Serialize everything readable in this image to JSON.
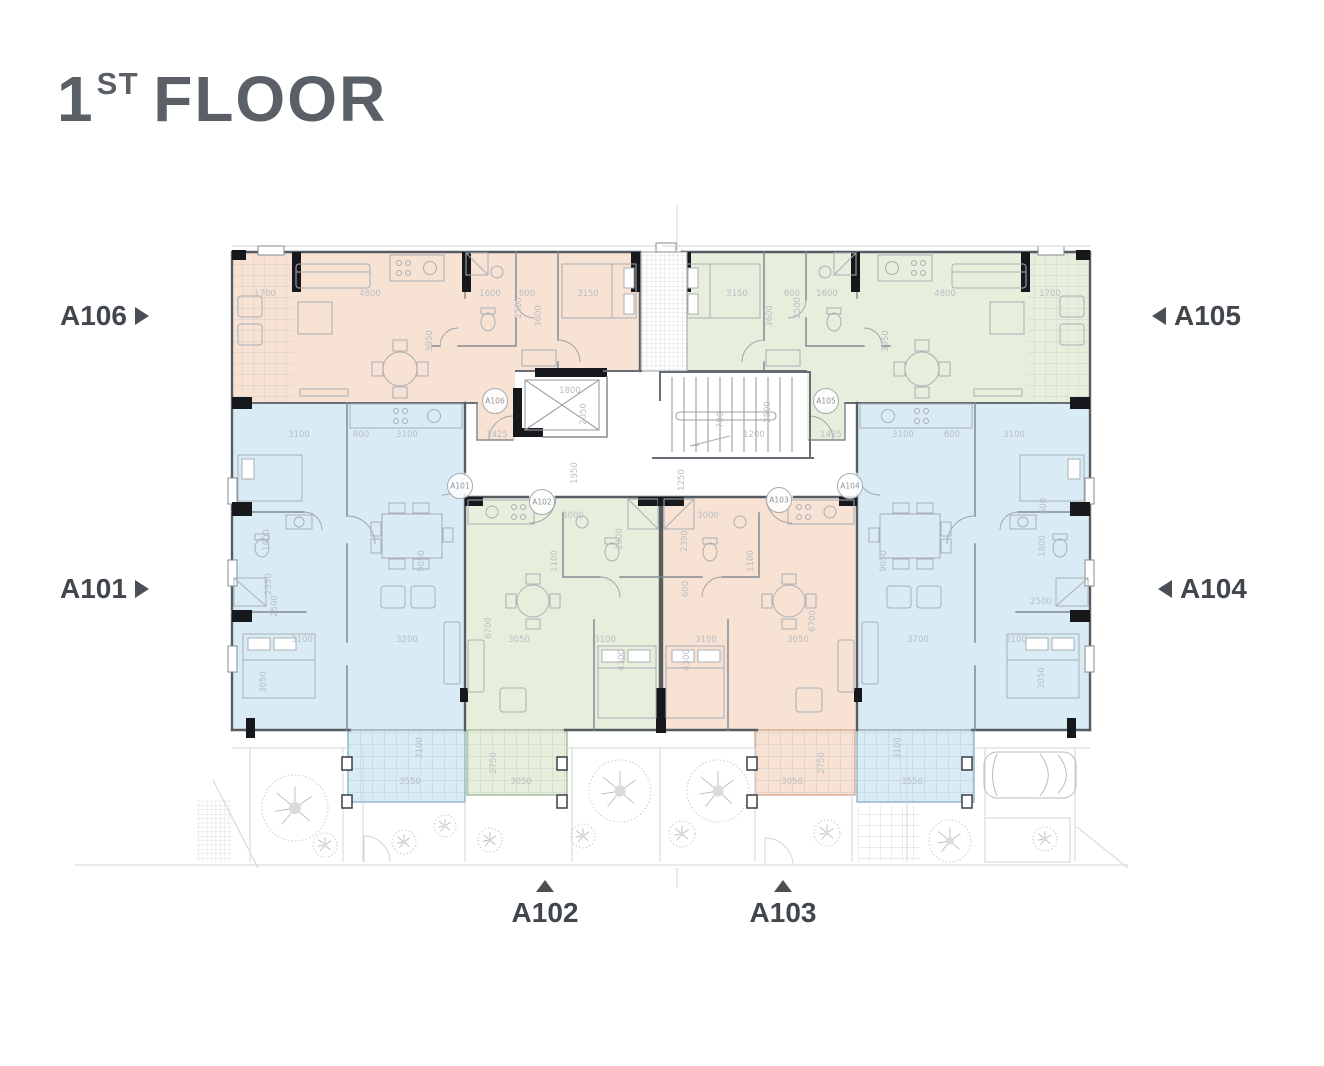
{
  "title": {
    "number": "1",
    "sup": "ST",
    "word": "FLOOR"
  },
  "callouts": {
    "a106": {
      "label": "A106",
      "arrow": "right"
    },
    "a105": {
      "label": "A105",
      "arrow": "left"
    },
    "a101": {
      "label": "A101",
      "arrow": "right"
    },
    "a104": {
      "label": "A104",
      "arrow": "left"
    },
    "a102": {
      "label": "A102",
      "arrow": "up"
    },
    "a103": {
      "label": "A103",
      "arrow": "up"
    }
  },
  "colors": {
    "title_text": "#5a6066",
    "callout_text": "#41474d",
    "wall": "#565c62",
    "black_wall": "#17181c",
    "dim_text": "#b9bec4",
    "peach": "#f8e2d3",
    "green": "#e7efdc",
    "blue": "#d9ecf6"
  },
  "units": [
    {
      "id": "A106",
      "fill": "#f8e2d3",
      "border": "#d3ab90"
    },
    {
      "id": "A105",
      "fill": "#e7efdc",
      "border": "#a8bb97"
    },
    {
      "id": "A101",
      "fill": "#d9ecf6",
      "border": "#8fb4cb"
    },
    {
      "id": "A102",
      "fill": "#e7efdc",
      "border": "#a8bb97"
    },
    {
      "id": "A103",
      "fill": "#f8e2d3",
      "border": "#d3ab90"
    },
    {
      "id": "A104",
      "fill": "#d9ecf6",
      "border": "#8fb4cb"
    }
  ],
  "plan": {
    "entry_labels": [
      {
        "t": "A106",
        "x": 495,
        "y": 401
      },
      {
        "t": "A105",
        "x": 826,
        "y": 401
      },
      {
        "t": "A101",
        "x": 460,
        "y": 486
      },
      {
        "t": "A102",
        "x": 542,
        "y": 502
      },
      {
        "t": "A103",
        "x": 779,
        "y": 500
      },
      {
        "t": "A104",
        "x": 850,
        "y": 486
      }
    ],
    "dim_labels": [
      {
        "t": "1700",
        "x": 265,
        "y": 296
      },
      {
        "t": "4800",
        "x": 370,
        "y": 296
      },
      {
        "t": "1600",
        "x": 490,
        "y": 296
      },
      {
        "t": "600",
        "x": 527,
        "y": 296
      },
      {
        "t": "3150",
        "x": 588,
        "y": 296
      },
      {
        "t": "3950",
        "x": 432,
        "y": 341,
        "r": 1
      },
      {
        "t": "2500",
        "x": 521,
        "y": 308,
        "r": 1
      },
      {
        "t": "3600",
        "x": 541,
        "y": 316,
        "r": 1
      },
      {
        "t": "3150",
        "x": 737,
        "y": 296
      },
      {
        "t": "600",
        "x": 792,
        "y": 296
      },
      {
        "t": "1600",
        "x": 827,
        "y": 296
      },
      {
        "t": "4800",
        "x": 945,
        "y": 296
      },
      {
        "t": "1700",
        "x": 1050,
        "y": 296
      },
      {
        "t": "2500",
        "x": 800,
        "y": 308,
        "r": 1
      },
      {
        "t": "3600",
        "x": 772,
        "y": 316,
        "r": 1
      },
      {
        "t": "3950",
        "x": 888,
        "y": 341,
        "r": 1
      },
      {
        "t": "1800",
        "x": 570,
        "y": 393
      },
      {
        "t": "2050",
        "x": 586,
        "y": 414,
        "r": 1
      },
      {
        "t": "700",
        "x": 723,
        "y": 420,
        "r": 1
      },
      {
        "t": "2500",
        "x": 770,
        "y": 412,
        "r": 1
      },
      {
        "t": "1200",
        "x": 754,
        "y": 437
      },
      {
        "t": "1425",
        "x": 497,
        "y": 437
      },
      {
        "t": "1425",
        "x": 831,
        "y": 437
      },
      {
        "t": "1950",
        "x": 577,
        "y": 473,
        "r": 1
      },
      {
        "t": "1250",
        "x": 684,
        "y": 480,
        "r": 1
      },
      {
        "t": "3100",
        "x": 299,
        "y": 437
      },
      {
        "t": "600",
        "x": 361,
        "y": 437
      },
      {
        "t": "3100",
        "x": 407,
        "y": 437
      },
      {
        "t": "3100",
        "x": 903,
        "y": 437
      },
      {
        "t": "600",
        "x": 952,
        "y": 437
      },
      {
        "t": "3100",
        "x": 1014,
        "y": 437
      },
      {
        "t": "1600",
        "x": 269,
        "y": 540,
        "r": 1
      },
      {
        "t": "2350",
        "x": 271,
        "y": 584,
        "r": 1
      },
      {
        "t": "2500",
        "x": 277,
        "y": 606,
        "r": 1
      },
      {
        "t": "9050",
        "x": 424,
        "y": 561,
        "r": 1
      },
      {
        "t": "3100",
        "x": 302,
        "y": 642
      },
      {
        "t": "3200",
        "x": 407,
        "y": 642
      },
      {
        "t": "3050",
        "x": 266,
        "y": 682,
        "r": 1
      },
      {
        "t": "3000",
        "x": 573,
        "y": 518
      },
      {
        "t": "2300",
        "x": 622,
        "y": 539,
        "r": 1
      },
      {
        "t": "1100",
        "x": 557,
        "y": 561,
        "r": 1
      },
      {
        "t": "6700",
        "x": 491,
        "y": 628,
        "r": 1
      },
      {
        "t": "3050",
        "x": 519,
        "y": 642
      },
      {
        "t": "3100",
        "x": 605,
        "y": 642
      },
      {
        "t": "4300",
        "x": 624,
        "y": 660,
        "r": 1
      },
      {
        "t": "3000",
        "x": 708,
        "y": 518
      },
      {
        "t": "2390",
        "x": 687,
        "y": 541,
        "r": 1
      },
      {
        "t": "1100",
        "x": 753,
        "y": 561,
        "r": 1
      },
      {
        "t": "600",
        "x": 688,
        "y": 589,
        "r": 1
      },
      {
        "t": "3100",
        "x": 706,
        "y": 642
      },
      {
        "t": "4300",
        "x": 689,
        "y": 660,
        "r": 1
      },
      {
        "t": "3050",
        "x": 798,
        "y": 642
      },
      {
        "t": "6700",
        "x": 815,
        "y": 621,
        "r": 1
      },
      {
        "t": "9050",
        "x": 886,
        "y": 561,
        "r": 1
      },
      {
        "t": "3700",
        "x": 918,
        "y": 642
      },
      {
        "t": "2500",
        "x": 1041,
        "y": 604
      },
      {
        "t": "3100",
        "x": 1016,
        "y": 642
      },
      {
        "t": "3050",
        "x": 1044,
        "y": 678,
        "r": 1
      },
      {
        "t": "600",
        "x": 1046,
        "y": 506,
        "r": 1
      },
      {
        "t": "1800",
        "x": 1045,
        "y": 546,
        "r": 1
      },
      {
        "t": "3100",
        "x": 422,
        "y": 748,
        "r": 1
      },
      {
        "t": "3550",
        "x": 410,
        "y": 784
      },
      {
        "t": "2750",
        "x": 496,
        "y": 763,
        "r": 1
      },
      {
        "t": "3050",
        "x": 521,
        "y": 784
      },
      {
        "t": "2750",
        "x": 824,
        "y": 763,
        "r": 1
      },
      {
        "t": "3050",
        "x": 792,
        "y": 784
      },
      {
        "t": "3100",
        "x": 900,
        "y": 748,
        "r": 1
      },
      {
        "t": "3550",
        "x": 912,
        "y": 784
      }
    ],
    "trees": [
      [
        295,
        808,
        33
      ],
      [
        325,
        845,
        12
      ],
      [
        404,
        842,
        12
      ],
      [
        445,
        826,
        11
      ],
      [
        490,
        840,
        12
      ],
      [
        583,
        836,
        12
      ],
      [
        620,
        791,
        31
      ],
      [
        682,
        834,
        13
      ],
      [
        718,
        791,
        31
      ],
      [
        827,
        833,
        13
      ],
      [
        950,
        841,
        21
      ],
      [
        1045,
        839,
        12
      ]
    ],
    "posts": [
      [
        347,
        757
      ],
      [
        347,
        795
      ],
      [
        562,
        757
      ],
      [
        562,
        795
      ],
      [
        752,
        757
      ],
      [
        752,
        795
      ],
      [
        967,
        757
      ],
      [
        967,
        795
      ]
    ]
  }
}
